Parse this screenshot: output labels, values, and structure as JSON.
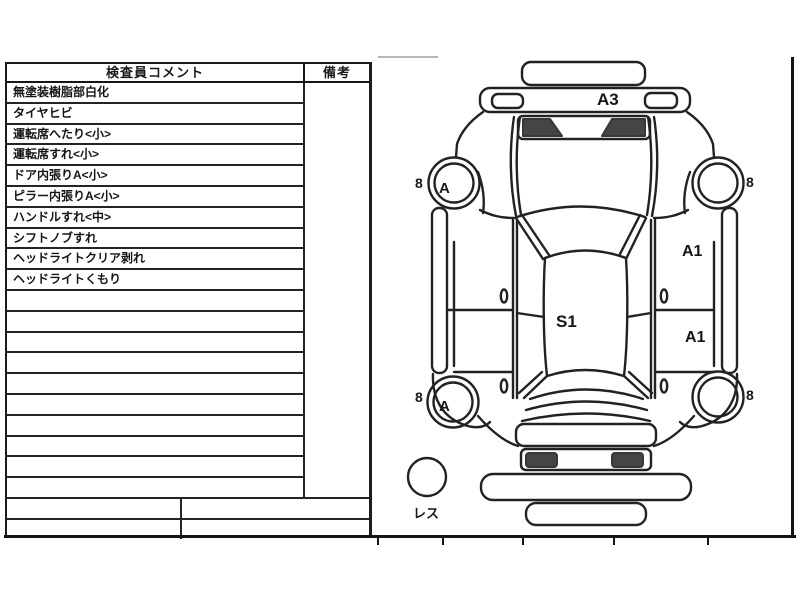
{
  "table": {
    "header": {
      "comments": "検査員コメント",
      "remarks": "備考"
    },
    "rows": [
      "無塗装樹脂部白化",
      "タイヤヒビ",
      "運転席へたり<小>",
      "運転席すれ<小>",
      "ドア内張りA<小>",
      "ピラー内張りA<小>",
      "ハンドルすれ<中>",
      "シフトノブすれ",
      "ヘッドライトクリア剥れ",
      "ヘッドライトくもり",
      "",
      "",
      "",
      "",
      "",
      "",
      "",
      "",
      "",
      ""
    ],
    "remarks_value": "",
    "footer_rows": [
      {
        "left": "",
        "right": ""
      },
      {
        "left": "",
        "right": ""
      }
    ]
  },
  "diagram": {
    "front_panel_label": "A3",
    "roof_label": "S1",
    "door_front_right_label": "A1",
    "door_rear_right_label": "A1",
    "wheel_front_left": {
      "size_label": "8",
      "inner_mark": "A"
    },
    "wheel_front_right": {
      "size_label": "8"
    },
    "wheel_rear_left": {
      "size_label": "8",
      "inner_mark": "A"
    },
    "wheel_rear_right": {
      "size_label": "8"
    },
    "spare_label": "レス"
  },
  "colors": {
    "line": "#222222",
    "dark_fill": "#454545",
    "paper": "#ffffff"
  }
}
